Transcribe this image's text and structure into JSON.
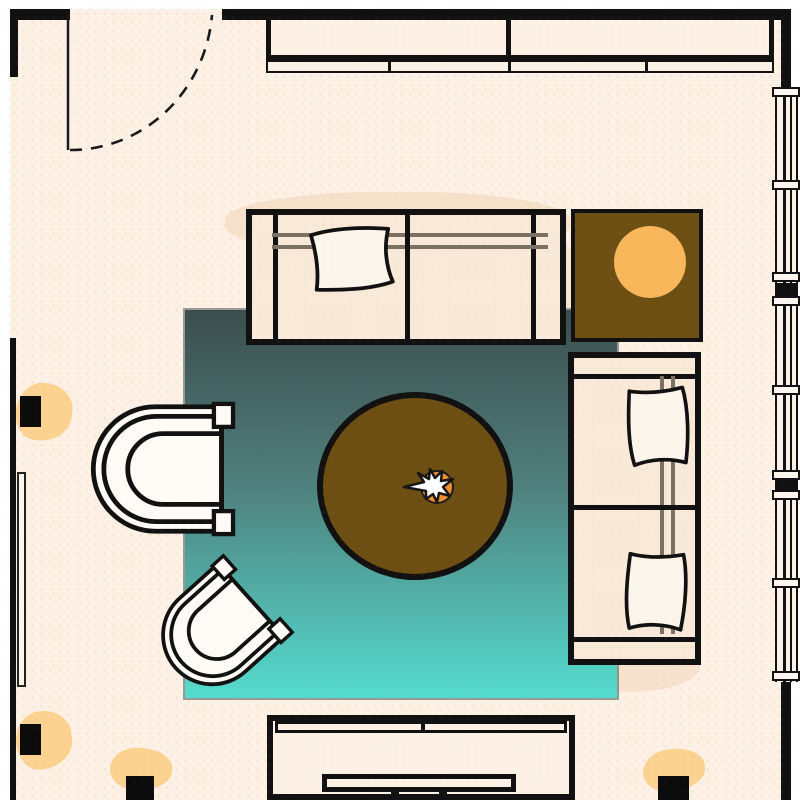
{
  "meta": {
    "kind": "floor-plan",
    "room": "living-room",
    "canvas_px": {
      "width": 800,
      "height": 800
    },
    "visible_text": "none"
  },
  "palette": {
    "outside": "#ffffff",
    "floor": "#fdf1e6",
    "wall": "#111111",
    "line": "#111111",
    "rug_top": "#3b4d4e",
    "rug_mid": "#4f7f7c",
    "rug_bottom": "#54dccf",
    "wood": "#6d4f13",
    "lamp_shade": "#f9b75b",
    "glow": "#fbd28f",
    "upholstery": "#f8e9d8",
    "pillow": "#fcf5ec",
    "chair_fill": "#fffcf7",
    "rail": "#7b7163",
    "decor_orange": "#ee8f35",
    "decor_star": "#ffffff",
    "smudge": "#f2d8bd"
  },
  "architecture": {
    "walls": [
      {
        "id": "wall-top-left",
        "side": "top",
        "bbox": [
          10,
          9,
          60,
          11
        ]
      },
      {
        "id": "wall-top-main",
        "side": "top",
        "bbox": [
          222,
          9,
          568,
          11
        ]
      },
      {
        "id": "wall-left-upper",
        "side": "left",
        "bbox": [
          10,
          9,
          8,
          68
        ]
      },
      {
        "id": "wall-left-lower",
        "side": "left",
        "bbox": [
          10,
          338,
          6,
          462
        ]
      },
      {
        "id": "wall-right-upper",
        "side": "right",
        "bbox": [
          781,
          9,
          10,
          81
        ]
      },
      {
        "id": "wall-right-lower",
        "side": "right",
        "bbox": [
          781,
          682,
          10,
          118
        ]
      }
    ],
    "door": {
      "id": "entry-door",
      "wall": "top",
      "hinge": [
        68,
        13
      ],
      "opening_span": [
        70,
        222
      ],
      "leaf": "vertical line into room",
      "swing": "dashed quarter arc"
    },
    "window_wall": {
      "id": "window-strip-right",
      "wall": "right",
      "bbox": [
        774,
        87,
        26,
        595
      ],
      "mullion": "double center line",
      "sill_caps_y": [
        87,
        180,
        272,
        296,
        385,
        470,
        490,
        578,
        671
      ],
      "wall_separators_y": [
        283,
        480
      ],
      "pane_count": 6
    }
  },
  "furniture": [
    {
      "id": "sideboard",
      "type": "long-cabinet",
      "wall": "top",
      "bbox": [
        266,
        20,
        508,
        53
      ],
      "sections": 2,
      "front_rail_divider_x": [
        388,
        508,
        645
      ]
    },
    {
      "id": "sofa-main",
      "type": "two-seat-sofa",
      "orientation": "horizontal-facing-south",
      "bbox": [
        246,
        209,
        320,
        136
      ],
      "seats": 2,
      "pillows": 1
    },
    {
      "id": "side-table",
      "type": "square-table",
      "bbox": [
        571,
        209,
        132,
        133
      ],
      "color_ref": "wood",
      "holds": "table-lamp"
    },
    {
      "id": "sofa-right",
      "type": "two-seat-sofa",
      "orientation": "vertical-facing-west",
      "bbox": [
        568,
        352,
        133,
        313
      ],
      "seats": 2,
      "pillows": 2
    },
    {
      "id": "coffee-table",
      "type": "round-table",
      "center": [
        415,
        486
      ],
      "radius_px": [
        98,
        94
      ],
      "color_ref": "wood",
      "holds": "centerpiece"
    },
    {
      "id": "armchair-1",
      "type": "tub-chair",
      "facing": "east",
      "bbox": [
        96,
        402,
        142,
        134
      ],
      "rotation_deg": 0
    },
    {
      "id": "armchair-2",
      "type": "tub-chair",
      "facing": "north-east",
      "center": [
        219,
        629
      ],
      "rotation_deg": -42
    },
    {
      "id": "media-console",
      "type": "tv-console",
      "wall": "bottom",
      "bbox": [
        267,
        715,
        308,
        85
      ],
      "tv_bbox": [
        322,
        774,
        194,
        18
      ]
    },
    {
      "id": "radiator-panel",
      "type": "wall-panel",
      "wall": "left",
      "bbox": [
        17,
        472,
        9,
        215
      ]
    },
    {
      "id": "area-rug",
      "type": "rug",
      "bbox": [
        185,
        310,
        432,
        388
      ],
      "style": "teal vertical gradient, dark at top to bright turquoise at bottom"
    }
  ],
  "lights": [
    {
      "id": "sconce-left-1",
      "type": "wall-light",
      "bbox": [
        20,
        396,
        21,
        31
      ],
      "glow": true
    },
    {
      "id": "sconce-left-2",
      "type": "wall-light",
      "bbox": [
        20,
        724,
        21,
        31
      ],
      "glow": true
    },
    {
      "id": "sconce-bottom-1",
      "type": "wall-light",
      "bbox": [
        126,
        776,
        28,
        24
      ],
      "glow": true
    },
    {
      "id": "sconce-bottom-2",
      "type": "wall-light",
      "bbox": [
        658,
        776,
        31,
        24
      ],
      "glow": true
    },
    {
      "id": "table-lamp",
      "type": "round-lamp",
      "center": [
        650,
        262
      ],
      "radius_px": 36,
      "color_ref": "lamp_shade"
    }
  ],
  "decor": [
    {
      "id": "centerpiece",
      "type": "plant-bowl-with-star-leaves",
      "center": [
        437,
        487
      ],
      "radius_px": 17,
      "colors": [
        "decor_orange",
        "decor_star"
      ]
    },
    {
      "id": "watercolor-smudges",
      "count": 5,
      "color_ref": "smudge"
    },
    {
      "id": "dot-texture",
      "style": "small warm halftone dots over whole plan"
    }
  ]
}
